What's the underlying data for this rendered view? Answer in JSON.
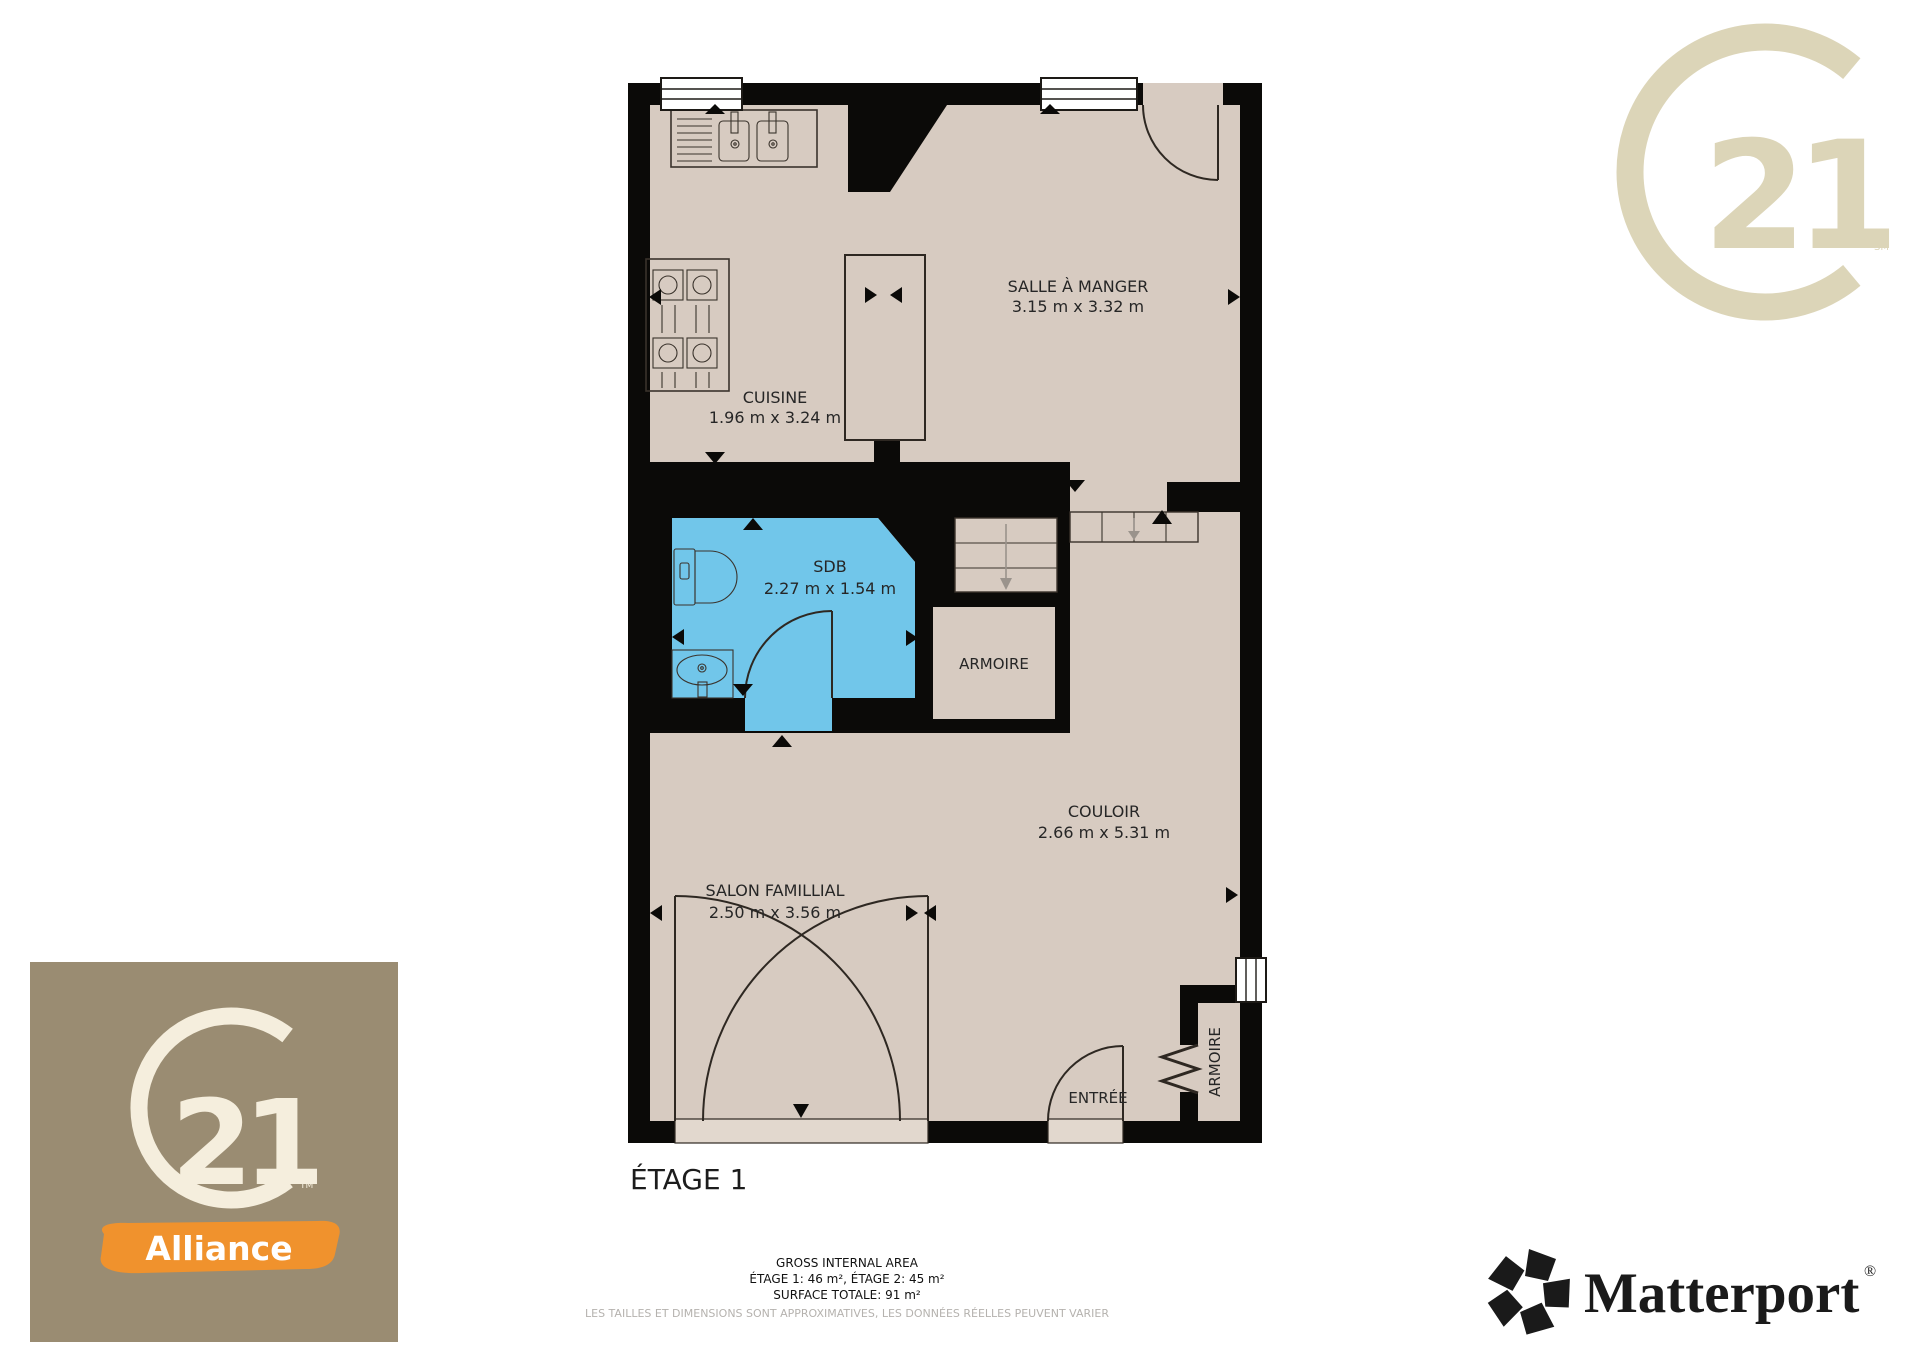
{
  "plan": {
    "floor_label": "ÉTAGE 1",
    "rooms": {
      "cuisine": {
        "name": "CUISINE",
        "dims": "1.96 m x 3.24 m"
      },
      "salle_a_manger": {
        "name": "SALLE À MANGER",
        "dims": "3.15 m x 3.32 m"
      },
      "sdb": {
        "name": "SDB",
        "dims": "2.27 m x 1.54 m"
      },
      "armoire_milieu": {
        "name": "ARMOIRE"
      },
      "couloir": {
        "name": "COULOIR",
        "dims": "2.66 m x 5.31 m"
      },
      "salon": {
        "name": "SALON FAMILLIAL",
        "dims": "2.50 m x 3.56 m"
      },
      "entree": {
        "name": "ENTRÉE"
      },
      "armoire_entree": {
        "name": "ARMOIRE"
      }
    },
    "colors": {
      "floor": "#d7cbc1",
      "wall": "#0b0a08",
      "bathroom_highlight": "#71c6ea",
      "threshold": "#e2d8ce"
    }
  },
  "footer": {
    "area_title": "GROSS INTERNAL AREA",
    "area_line1": "ÉTAGE 1: 46 m², ÉTAGE 2: 45 m²",
    "area_line2": "SURFACE TOTALE: 91 m²",
    "disclaimer": "LES TAILLES ET DIMENSIONS SONT APPROXIMATIVES, LES DONNÉES RÉELLES PEUVENT VARIER",
    "disclaimer_color": "#b5b2ae"
  },
  "logos": {
    "century21_watermark": {
      "number": "21",
      "mark": "SM",
      "color": "#dcd5b8"
    },
    "agency": {
      "number": "21",
      "mark": "TM",
      "name": "Alliance",
      "bg": "#9a8c72",
      "fg": "#f5eedd",
      "banner": "#f0922d"
    },
    "matterport": {
      "name": "Matterport",
      "registered": "®",
      "color": "#1a1a1a"
    }
  }
}
